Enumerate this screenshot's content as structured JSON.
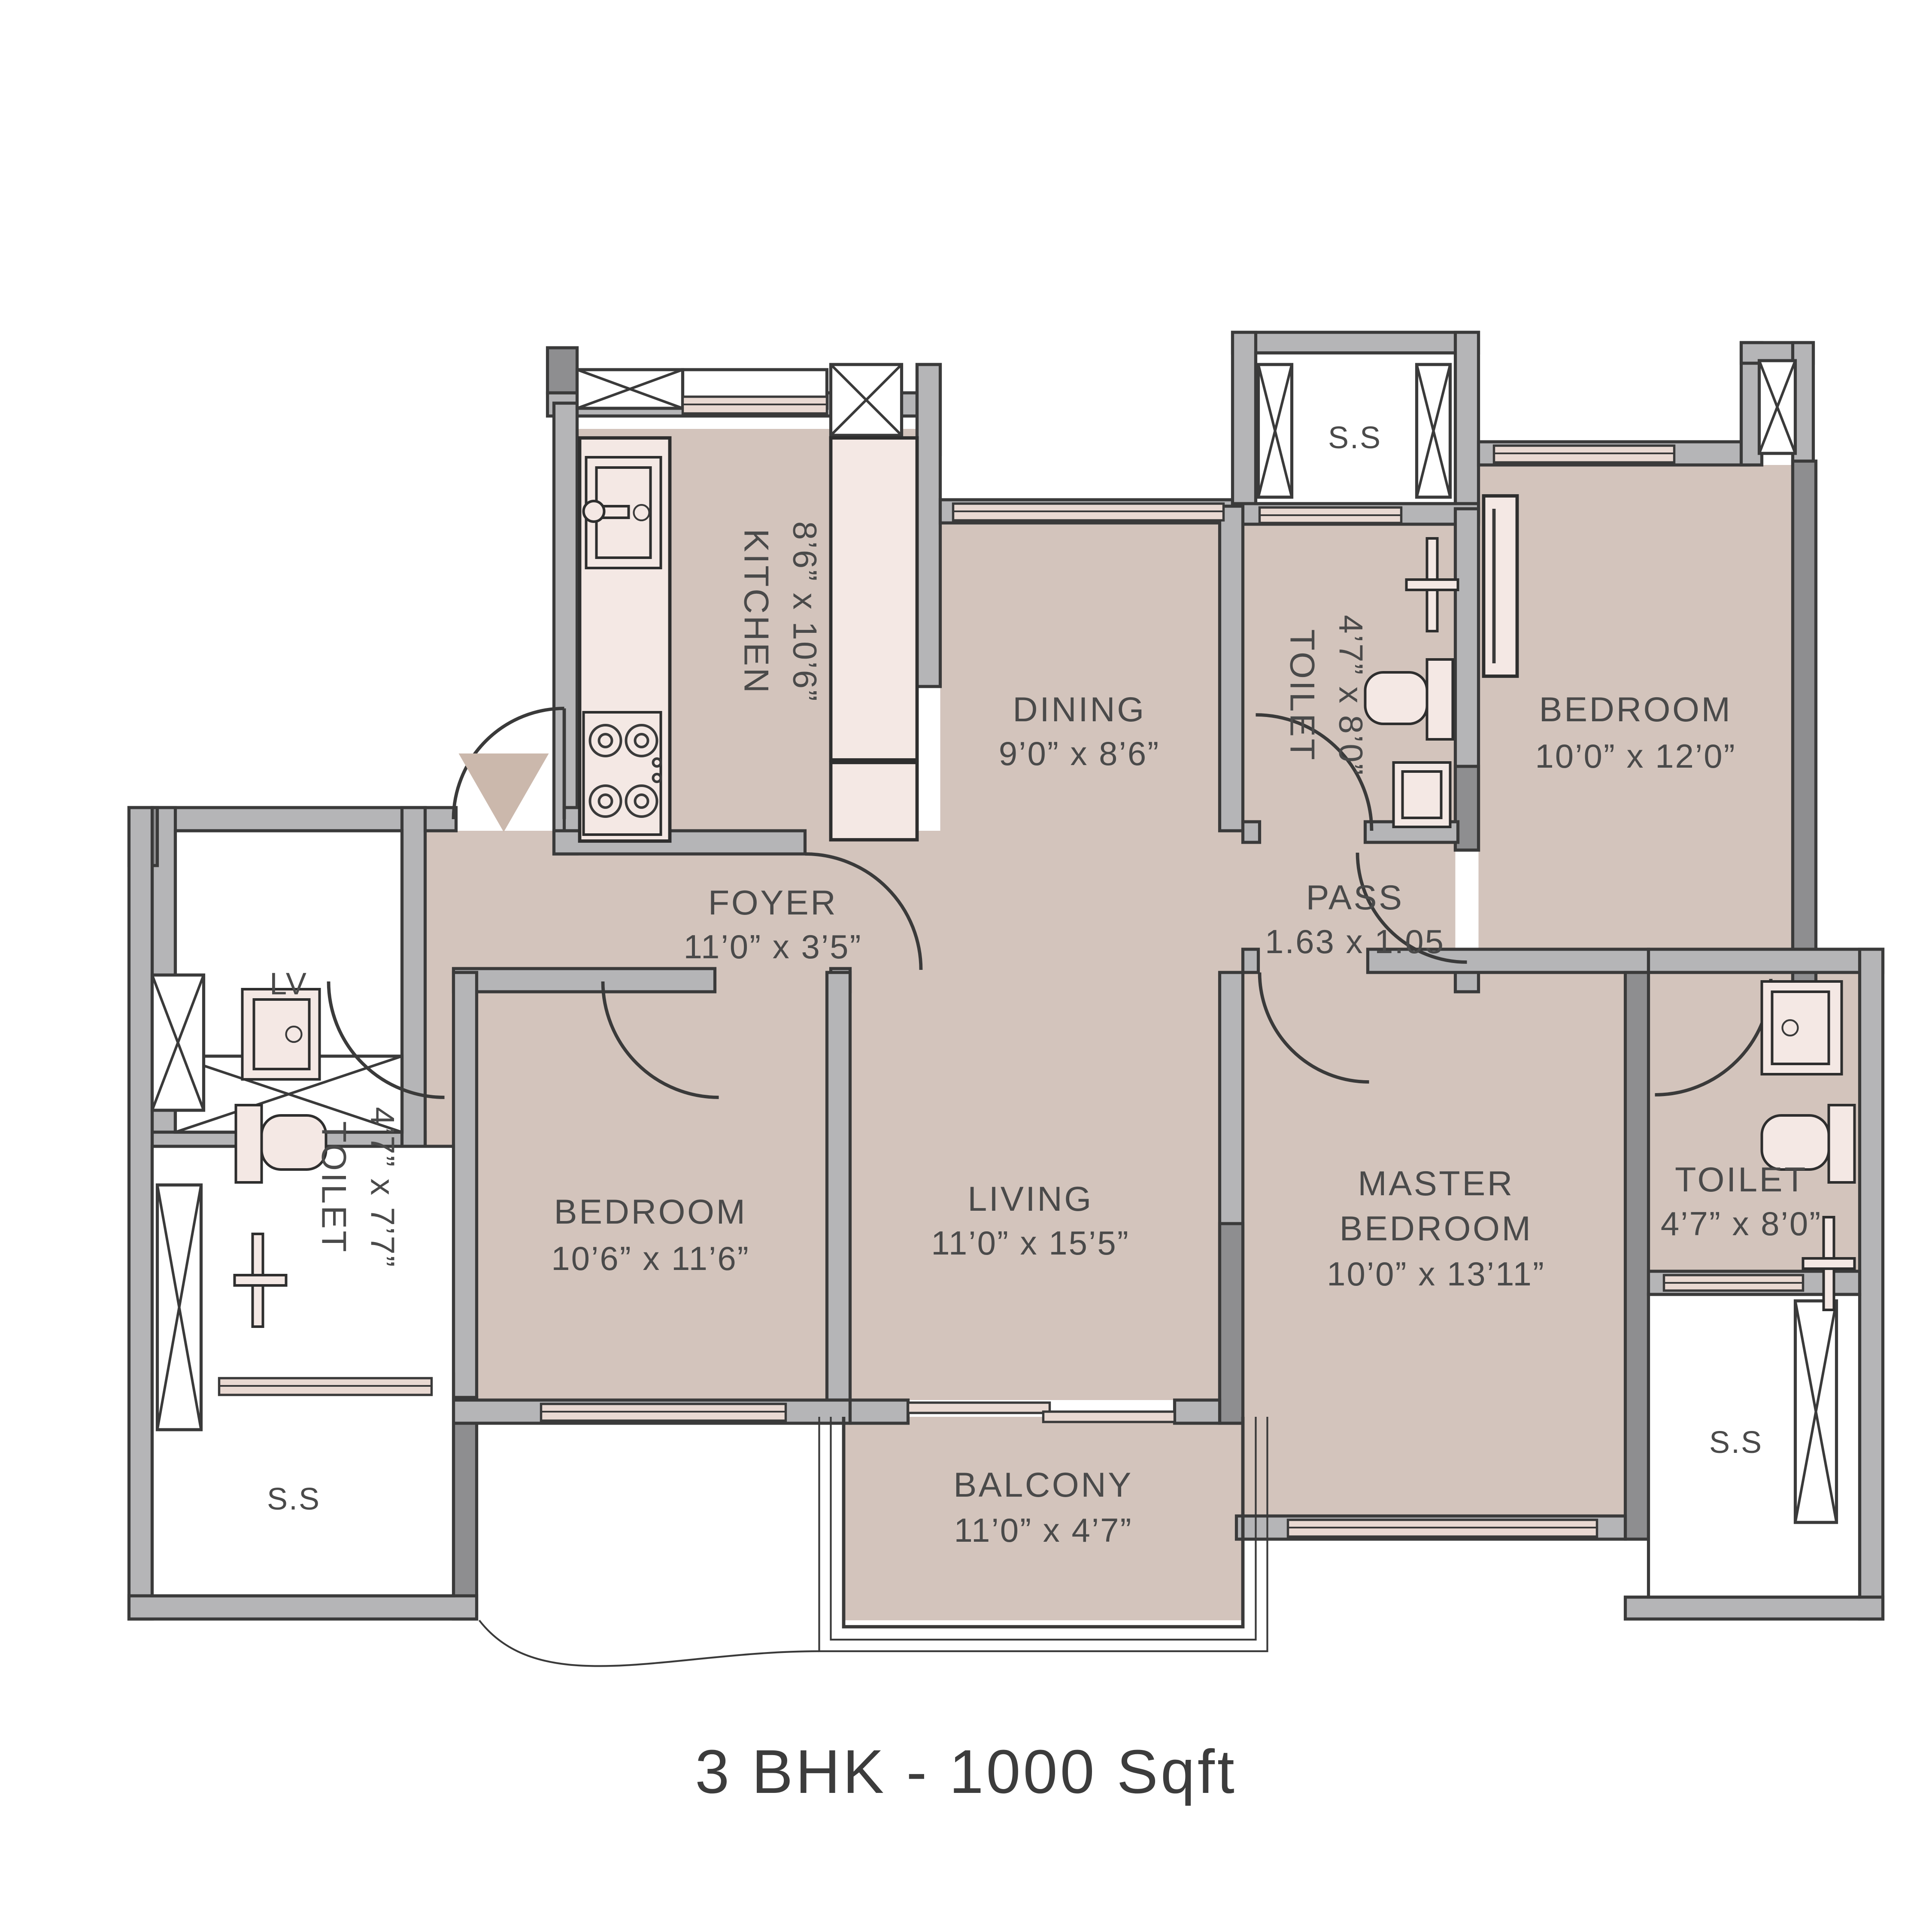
{
  "title": "3 BHK - 1000 Sqft",
  "rooms": {
    "kitchen": {
      "name": "KITCHEN",
      "dims": "8’6” x 10’6”"
    },
    "dining": {
      "name": "DINING",
      "dims": "9’0” x 8’6”"
    },
    "toilet_top": {
      "name": "TOILET",
      "dims": "4’7” x 8’0”"
    },
    "bedroom_top": {
      "name": "BEDROOM",
      "dims": "10’0” x 12’0”"
    },
    "foyer": {
      "name": "FOYER",
      "dims": "11’0” x 3’5”"
    },
    "pass": {
      "name": "PASS",
      "dims": "1.63 x 1.05"
    },
    "toilet_left": {
      "name": "TOILET",
      "dims": "4’7” x 7’7”"
    },
    "bedroom_left": {
      "name": "BEDROOM",
      "dims": "10’6” x 11’6”"
    },
    "living": {
      "name": "LIVING",
      "dims": "11’0” x 15’5”"
    },
    "master_bedroom": {
      "name1": "MASTER",
      "name2": "BEDROOM",
      "dims": "10’0” x 13’11”"
    },
    "toilet_right": {
      "name": "TOILET",
      "dims": "4’7” x 8’0”"
    },
    "balcony": {
      "name": "BALCONY",
      "dims": "11’0” x 4’7”"
    }
  },
  "shafts": {
    "lift": "LV",
    "ss_top": "S.S",
    "ss_left": "S.S",
    "ss_right": "S.S"
  },
  "colors": {
    "floor": "#d3c4bc",
    "wall_light": "#b5b5b7",
    "wall_dark": "#8e8e90",
    "fixture": "#f4e8e4",
    "window": "#e9d9d2",
    "line": "#3a3a3a",
    "label": "#4a4a4a",
    "title": "#3c3c3c",
    "entry_arrow": "#cbb8ac"
  }
}
